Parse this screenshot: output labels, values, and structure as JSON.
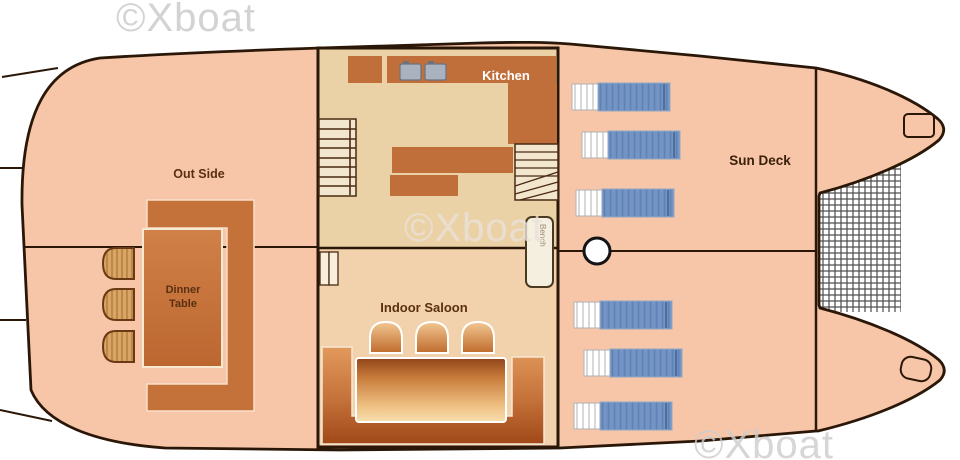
{
  "watermark": {
    "text": "©Xboat"
  },
  "labels": {
    "out_side": "Out Side",
    "kitchen": "Kitchen",
    "indoor_saloon": "Indoor Saloon",
    "sun_deck": "Sun Deck",
    "dinner_table_line1": "Dinner",
    "dinner_table_line2": "Table",
    "bench": "Bench"
  },
  "colors": {
    "hull_fill": "#F7C6A9",
    "hull_outline": "#2B1708",
    "kitchen_floor": "#EBD2A6",
    "saloon_floor": "#F2D2AC",
    "counter": "#C06F3B",
    "bench_seat": "#C4713A",
    "dinner_table": "#CC7C45",
    "stool": "#D9A768",
    "lounger_blue": "#7394C4",
    "lounger_head": "#FFFFFF",
    "net_line": "#4A4A4A",
    "label_text": "#5A3010",
    "kitchen_label": "#FFFFFF",
    "watermark_gray": "#CCCCCC"
  }
}
